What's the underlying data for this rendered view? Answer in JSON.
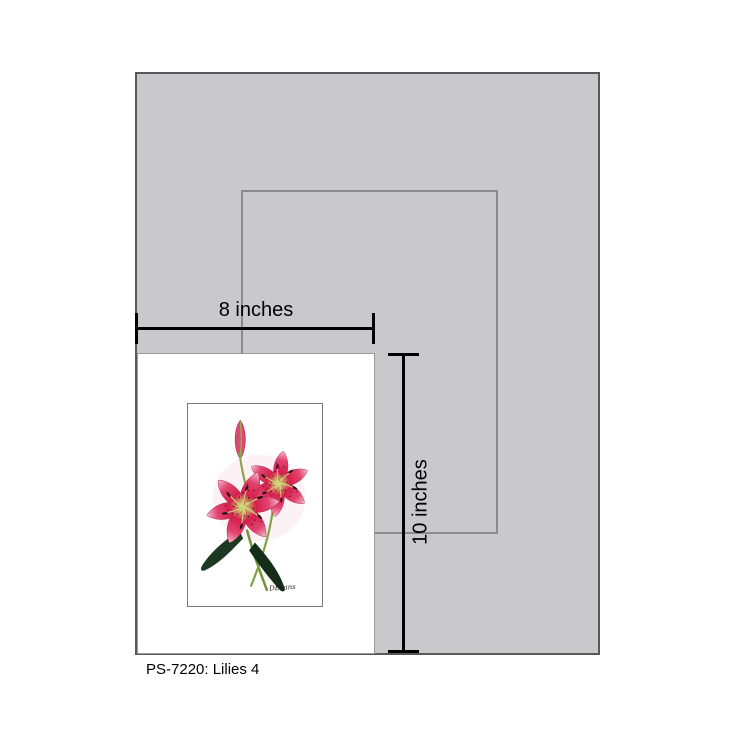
{
  "caption": "PS-7220: Lilies 4",
  "measurements": {
    "width_label": "8 inches",
    "height_label": "10 inches"
  },
  "artwork": {
    "title": "Lilies 4",
    "signature": "DEvans"
  },
  "colors": {
    "sheet_gray": "#c9c9cb",
    "sheet_border_gray": "#58585a",
    "opening_outline_gray": "#8b8b8d",
    "card_white": "#ffffff",
    "card_border_gray": "#9b9b9d",
    "measure_black": "#000000",
    "petal_deep_pink": "#d6204e",
    "petal_light_pink": "#f0a3bb",
    "petal_throat_cream": "#e9e0b4",
    "petal_spot_maroon": "#6b0f28",
    "anther_dark": "#27141a",
    "leaf_dark_green": "#1b3a21",
    "stem_green": "#7d9a3a"
  }
}
